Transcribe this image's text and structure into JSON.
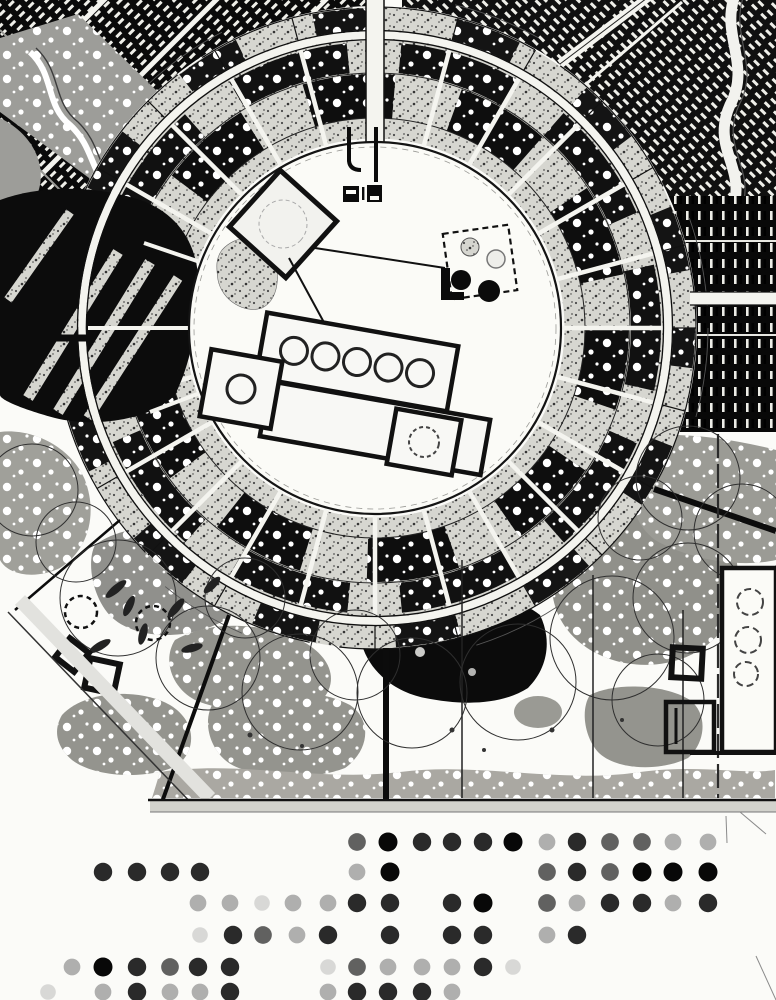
{
  "meta": {
    "label": "circular-city-master-plan-drawing",
    "media": "black-and-white scanned site plan, no text visible"
  },
  "palette": {
    "paper": "#fbfbf8",
    "ink": "#0b0b0b",
    "stipple_base": "#d6d6d0",
    "vegetation_gray": "#949490",
    "vegetation_light": "#aaa8a2",
    "road_white": "#f4f4ef"
  },
  "regions": [
    "city-district-top-left",
    "park-band-top-left",
    "city-district-top-right",
    "city-district-right",
    "ring-bands",
    "ring-road",
    "radial-spokes",
    "left-dark-district",
    "central-plaza",
    "plaza-buildings",
    "lake",
    "vegetation-blobs",
    "tree-canopies",
    "approach-roads",
    "site-boundary",
    "map-border",
    "legend-dot-grid"
  ],
  "legend_dots": {
    "radius": 9.5,
    "tones": {
      "black": "#080808",
      "dark": "#1f1f1f",
      "medium": "#454545",
      "light": "#7d7d7d",
      "faint": "#a8a8a8"
    },
    "opacity": {
      "black": 1,
      "dark": 0.95,
      "medium": 0.85,
      "light": 0.6,
      "faint": 0.42
    },
    "scale": {
      "black": 1,
      "dark": 0.97,
      "medium": 0.93,
      "light": 0.88,
      "faint": 0.82
    },
    "rows": [
      {
        "y": 842,
        "dots": [
          {
            "x": 357,
            "t": "medium"
          },
          {
            "x": 388,
            "t": "black"
          },
          {
            "x": 422,
            "t": "dark"
          },
          {
            "x": 452,
            "t": "dark"
          },
          {
            "x": 483,
            "t": "dark"
          },
          {
            "x": 513,
            "t": "black"
          },
          {
            "x": 547,
            "t": "light"
          },
          {
            "x": 577,
            "t": "dark"
          },
          {
            "x": 610,
            "t": "medium"
          },
          {
            "x": 642,
            "t": "medium"
          },
          {
            "x": 673,
            "t": "light"
          },
          {
            "x": 708,
            "t": "light"
          }
        ]
      },
      {
        "y": 872,
        "dots": [
          {
            "x": 103,
            "t": "dark"
          },
          {
            "x": 137,
            "t": "dark"
          },
          {
            "x": 170,
            "t": "dark"
          },
          {
            "x": 200,
            "t": "dark"
          },
          {
            "x": 357,
            "t": "light"
          },
          {
            "x": 390,
            "t": "black"
          },
          {
            "x": 547,
            "t": "medium"
          },
          {
            "x": 577,
            "t": "dark"
          },
          {
            "x": 610,
            "t": "medium"
          },
          {
            "x": 642,
            "t": "black"
          },
          {
            "x": 673,
            "t": "black"
          },
          {
            "x": 708,
            "t": "black"
          }
        ]
      },
      {
        "y": 903,
        "dots": [
          {
            "x": 198,
            "t": "light"
          },
          {
            "x": 230,
            "t": "light"
          },
          {
            "x": 262,
            "t": "faint"
          },
          {
            "x": 293,
            "t": "light"
          },
          {
            "x": 328,
            "t": "light"
          },
          {
            "x": 357,
            "t": "dark"
          },
          {
            "x": 390,
            "t": "dark"
          },
          {
            "x": 452,
            "t": "dark"
          },
          {
            "x": 483,
            "t": "black"
          },
          {
            "x": 547,
            "t": "medium"
          },
          {
            "x": 577,
            "t": "light"
          },
          {
            "x": 610,
            "t": "dark"
          },
          {
            "x": 642,
            "t": "dark"
          },
          {
            "x": 673,
            "t": "light"
          },
          {
            "x": 708,
            "t": "dark"
          }
        ]
      },
      {
        "y": 935,
        "dots": [
          {
            "x": 200,
            "t": "faint"
          },
          {
            "x": 233,
            "t": "dark"
          },
          {
            "x": 263,
            "t": "medium"
          },
          {
            "x": 297,
            "t": "light"
          },
          {
            "x": 328,
            "t": "dark"
          },
          {
            "x": 390,
            "t": "dark"
          },
          {
            "x": 452,
            "t": "dark"
          },
          {
            "x": 483,
            "t": "dark"
          },
          {
            "x": 547,
            "t": "light"
          },
          {
            "x": 577,
            "t": "dark"
          }
        ]
      },
      {
        "y": 967,
        "dots": [
          {
            "x": 72,
            "t": "light"
          },
          {
            "x": 103,
            "t": "black"
          },
          {
            "x": 137,
            "t": "dark"
          },
          {
            "x": 170,
            "t": "medium"
          },
          {
            "x": 198,
            "t": "dark"
          },
          {
            "x": 230,
            "t": "dark"
          },
          {
            "x": 328,
            "t": "faint"
          },
          {
            "x": 357,
            "t": "medium"
          },
          {
            "x": 388,
            "t": "light"
          },
          {
            "x": 422,
            "t": "light"
          },
          {
            "x": 452,
            "t": "light"
          },
          {
            "x": 483,
            "t": "dark"
          },
          {
            "x": 513,
            "t": "faint"
          }
        ]
      },
      {
        "y": 992,
        "dots": [
          {
            "x": 48,
            "t": "faint"
          },
          {
            "x": 103,
            "t": "light"
          },
          {
            "x": 137,
            "t": "dark"
          },
          {
            "x": 170,
            "t": "light"
          },
          {
            "x": 200,
            "t": "light"
          },
          {
            "x": 230,
            "t": "dark"
          },
          {
            "x": 328,
            "t": "light"
          },
          {
            "x": 357,
            "t": "dark"
          },
          {
            "x": 388,
            "t": "dark"
          },
          {
            "x": 422,
            "t": "dark"
          },
          {
            "x": 452,
            "t": "light"
          }
        ]
      }
    ]
  }
}
